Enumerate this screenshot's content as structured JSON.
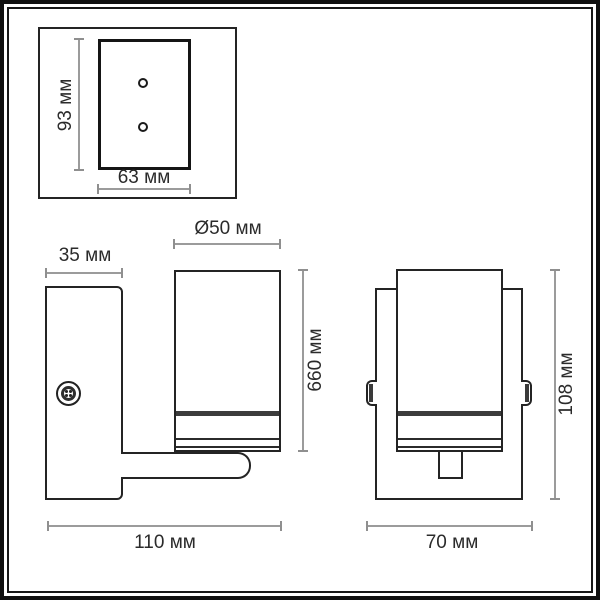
{
  "dimensions": {
    "top_view": {
      "height": "93 мм",
      "width": "63 мм"
    },
    "side_view": {
      "plate_width": "35 мм",
      "shade_diameter": "Ø50 мм",
      "body_height": "660 мм",
      "total_depth": "110 мм"
    },
    "front_view": {
      "height": "108 мм",
      "width": "70 мм"
    }
  }
}
